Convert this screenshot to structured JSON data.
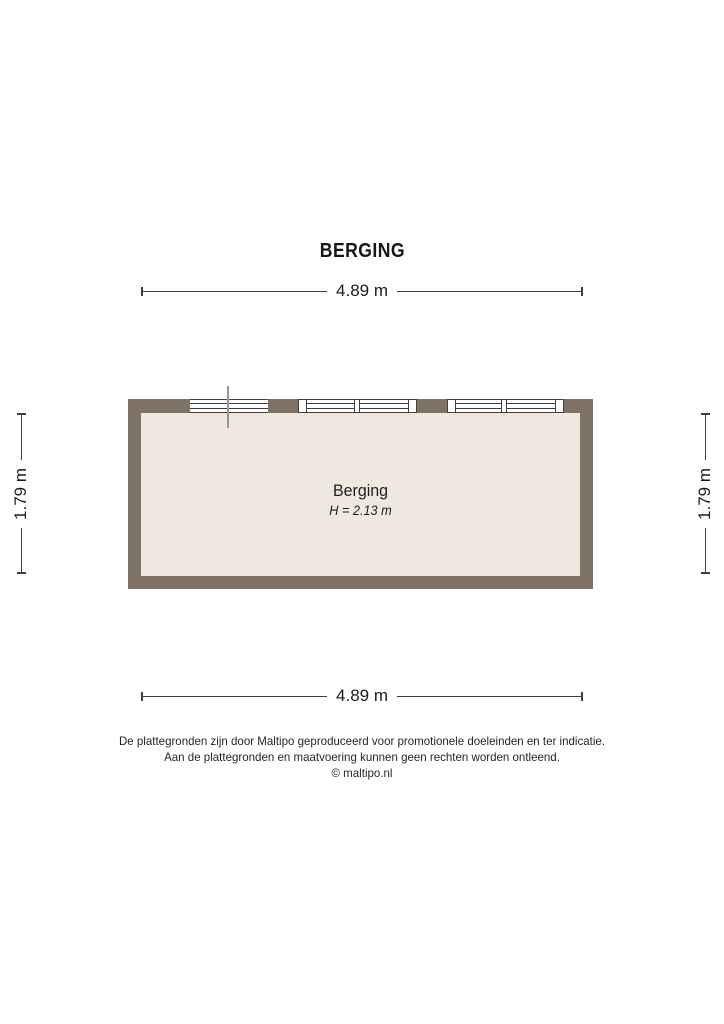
{
  "title": "BERGING",
  "room": {
    "name": "Berging",
    "height_label": "H = 2.13 m"
  },
  "dimensions": {
    "top": "4.89 m",
    "bottom": "4.89 m",
    "left": "1.79 m",
    "right": "1.79 m"
  },
  "footer": {
    "disclaimer_line1": "De plattegronden zijn door Maltipo geproduceerd voor promotionele doeleinden en ter indicatie.",
    "disclaimer_line2": "Aan de plattegronden en maatvoering kunnen geen rechten worden ontleend.",
    "copyright": "© maltipo.nl"
  },
  "colors": {
    "wall": "#7e7266",
    "floor": "#efe8df",
    "line": "#3e3e3e",
    "window_frame": "#3f3f3f",
    "section_line": "#9a958d",
    "background": "#ffffff"
  }
}
